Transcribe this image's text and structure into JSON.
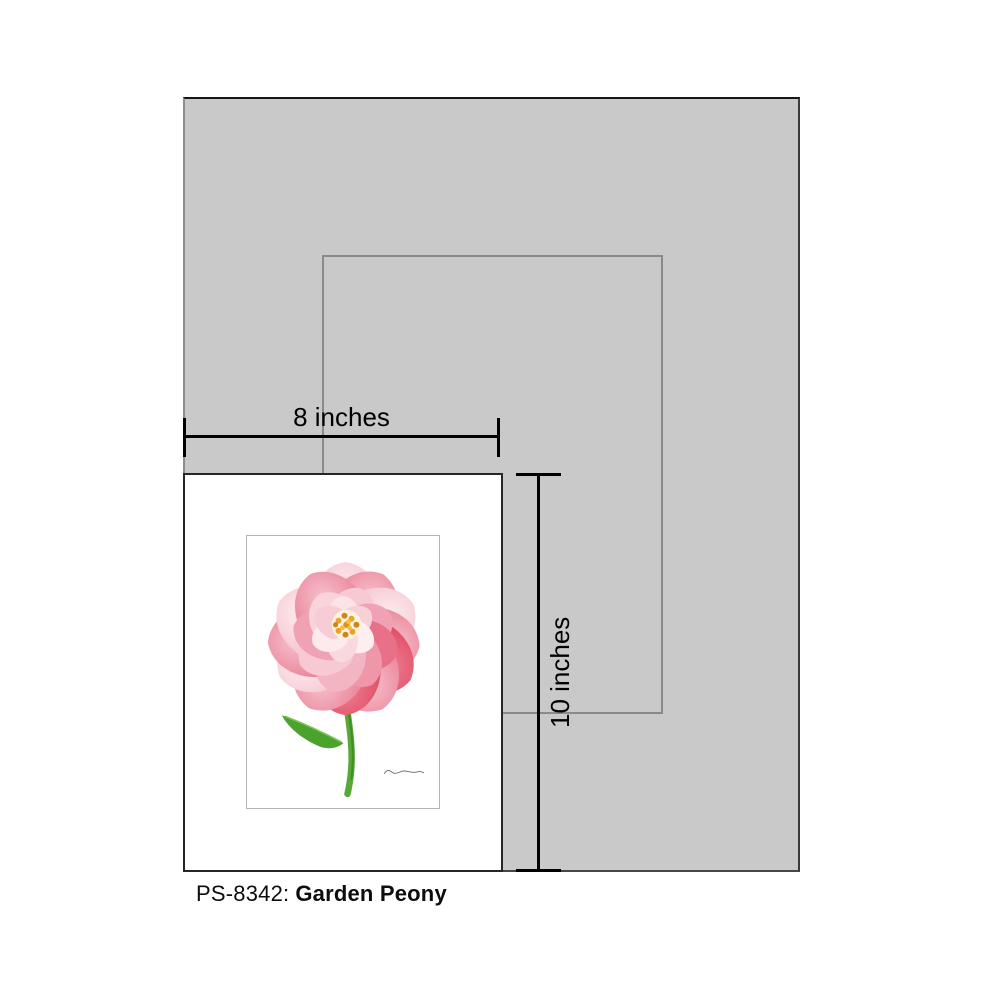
{
  "caption": {
    "code": "PS-8342:",
    "title": "Garden Peony"
  },
  "dimensions": {
    "width_label": "8 inches",
    "height_label": "10 inches"
  },
  "colors": {
    "mat_gray": "#c9c9c9",
    "medium_outline_gray": "#8a8a8a",
    "print_border": "#262626",
    "art_border": "#b3b3b3",
    "dimension_line": "#000000",
    "caption_text": "#0d0d0d"
  },
  "artwork": {
    "subject": "pink garden peony with green stem and leaf, signed",
    "palette": {
      "petal_light": "#fbdfe5",
      "petal_blush": "#f7c9d2",
      "petal_pink": "#f0a2b4",
      "petal_rose": "#e87089",
      "petal_deep": "#e0485f",
      "petal_coral": "#d93a52",
      "stamen_gold": "#e9a32b",
      "stamen_dark": "#cf841c",
      "leaf_green": "#4ca32c",
      "stem_green": "#58a838",
      "signature_ink": "#666666"
    }
  }
}
